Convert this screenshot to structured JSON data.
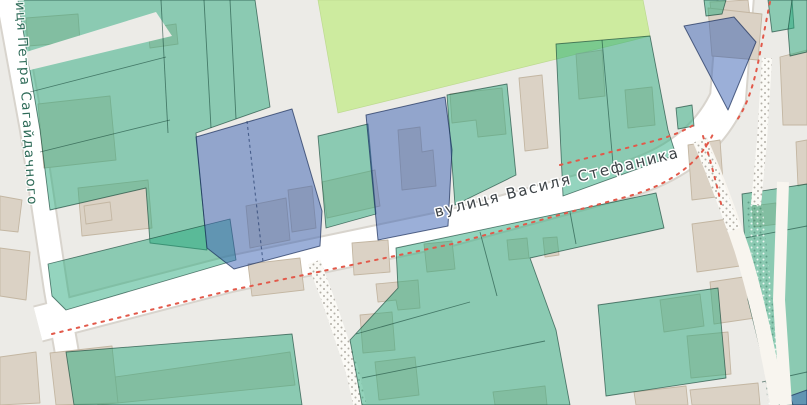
{
  "map": {
    "labels": {
      "street_main": "вулиця Василя Стефаника",
      "street_left": "вулиця Петра Сагайдачного"
    },
    "palette": {
      "background": "#ecebe7",
      "park": "#cdeb9f",
      "parcel_teal": "#2aa97e",
      "parcel_blue": "#3860b2",
      "building": "#dbd2c5",
      "road": "#ffffff",
      "road_marking_red": "#e2594a",
      "footpath_dots": "#b3afa7",
      "label_main_color": "#3d4347",
      "label_left_color": "#2e6b58"
    }
  }
}
